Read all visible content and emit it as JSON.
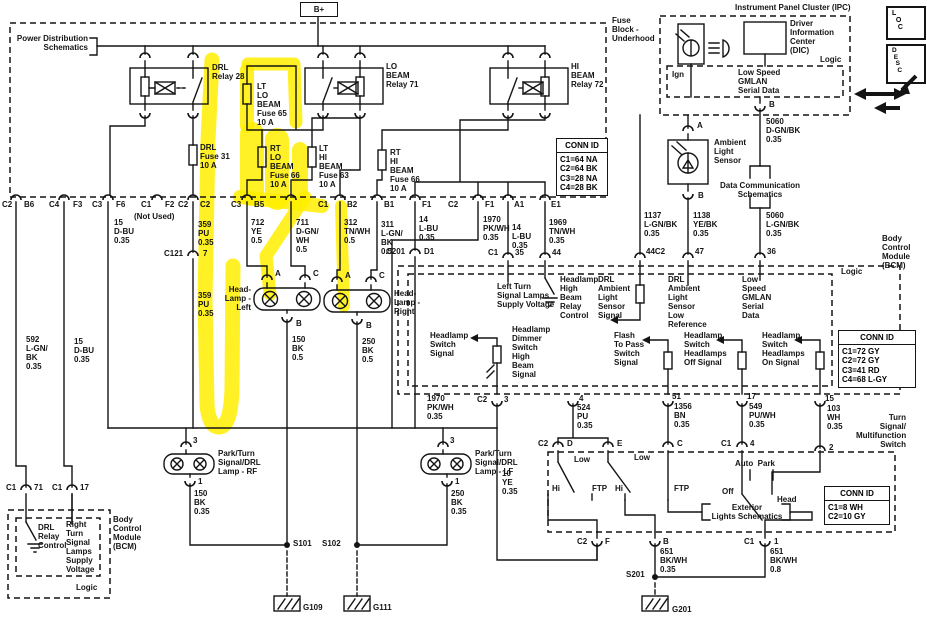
{
  "power": {
    "bplus": "B+",
    "schematics": "Power Distribution\nSchematics",
    "fuse_block": "Fuse\nBlock -\nUnderhood"
  },
  "relays": {
    "drl": "DRL\nRelay 28",
    "lo": "LO\nBEAM\nRelay 71",
    "hi": "HI\nBEAM\nRelay 72"
  },
  "fuses": {
    "lt_lo": "LT\nLO\nBEAM\nFuse 65\n10 A",
    "drl": "DRL\nFuse 31\n10 A",
    "rt_lo": "RT\nLO\nBEAM\nFuse 66\n10 A",
    "lt_hi": "LT\nHI\nBEAM\nFuse 63\n10 A",
    "rt_hi": "RT\nHI\nBEAM\nFuse 66\n10 A"
  },
  "ipc": {
    "title": "Instrument Panel Cluster (IPC)",
    "dic": "Driver\nInformation\nCenter\n(DIC)",
    "logic": "Logic",
    "ign": "Ign",
    "gmlan": "Low Speed\nGMLAN\nSerial Data",
    "pin_b": "B"
  },
  "badges": {
    "loc": "L\n  O\n   C",
    "desc": "D\n E\n  S\n   C"
  },
  "sensor": {
    "label": "Ambient\nLight\nSensor",
    "pin_a": "A",
    "pin_b": "B"
  },
  "datacomm": {
    "label": "Data Communication\nSchematics"
  },
  "conn_ids": {
    "title": "CONN ID",
    "fuse_block": "C1=64 NA\nC2=64 BK\nC3=28 NA\nC4=28 BK",
    "bcm": "C1=72 GY\nC2=72 GY\nC3=41 RD\nC4=68 L-GY",
    "tsmfs": "C1=8 WH\nC2=10 GY"
  },
  "row": {
    "c2a": "C2",
    "b6": "B6",
    "c4": "C4",
    "f3": "F3",
    "c3a": "C3",
    "f6": "F6",
    "c1a": "C1",
    "f2": "F2",
    "not_used": "(Not Used)",
    "c2b": "C2",
    "c2c": "C2",
    "c3b": "C3",
    "b5": "B5",
    "c1b": "C1",
    "b2": "B2",
    "b1": "B1",
    "f1a": "F1",
    "c2d": "C2",
    "f1b": "F1",
    "a1": "A1",
    "e1": "E1"
  },
  "wires": {
    "w15a": "15\nD-BU\n0.35",
    "w359a": "359\nPU\n0.35",
    "w712": "712\nYE\n0.5",
    "w711": "711\nD-GN/\nWH\n0.5",
    "w312": "312\nTN/WH\n0.5",
    "w311": "311\nL-GN/\nBK\n0.5",
    "w14a": "14\nL-BU\n0.35",
    "w1970a": "1970\nPK/WH\n0.35",
    "w14b": "14\nL-BU\n0.35",
    "w1969": "1969\nTN/WH\n0.35",
    "w359b": "359\nPU\n0.35",
    "w592": "592\nL-GN/\nBK\n0.35",
    "w15b": "15\nD-BU\n0.35",
    "w150a": "150\nBK\n0.5",
    "w250a": "250\nBK\n0.5",
    "w150b": "150\nBK\n0.35",
    "w250b": "250\nBK\n0.35",
    "w5060a": "5060\nD-GN/BK\n0.35",
    "w5060b": "5060\nL-GN/BK\n0.35",
    "w1137": "1137\nL-GN/BK\n0.35",
    "w1138": "1138\nYE/BK\n0.35",
    "w1970b": "1970\nPK/WH\n0.35",
    "w524": "524\nPU\n0.35",
    "w1356": "1356\nBN\n0.35",
    "w549": "549\nPU/WH\n0.35",
    "w103": "103\nWH\n0.35",
    "w10": "10\nYE\n0.35",
    "w651a": "651\nBK/WH\n0.35",
    "w651b": "651\nBK/WH\n0.8"
  },
  "pins": {
    "c121": "C121",
    "c121_7": "7",
    "c201": "C201",
    "d1": "D1",
    "c1a": "C1",
    "p35": "35",
    "p44": "44",
    "p44c2": "44C2",
    "p47": "47",
    "p36": "36",
    "hl_a": "A",
    "hl_c": "C",
    "hl_b": "B",
    "hr_a": "A",
    "hr_c": "C",
    "hr_b": "B",
    "rf_3": "3",
    "rf_1": "1",
    "lf_3": "3",
    "lf_1": "1",
    "bp_c2": "C2",
    "bp_3": "3",
    "bp_4": "4",
    "bp_51": "51",
    "bp_17": "17",
    "bp_15": "15",
    "ts_c2": "C2",
    "ts_d": "D",
    "ts_e": "E",
    "ts_c": "C",
    "ts_c1": "C1",
    "ts_4": "4",
    "ts_2": "2",
    "eb_c2": "C2",
    "eb_f": "F",
    "eb_b": "B",
    "eb_c1": "C1",
    "eb_1": "1",
    "lb_c1a": "C1",
    "lb_71": "71",
    "lb_c1b": "C1",
    "lb_17": "17"
  },
  "headlamps": {
    "left": "Head-\nLamp -\nLeft",
    "right": "Head-\nLamp -\nRight"
  },
  "park_lamps": {
    "rf": "Park/Turn\nSignal/DRL\nLamp - RF",
    "lf": "Park/Turn\nSignal/DRL\nLamp - LF"
  },
  "bcm": {
    "name": "Body\nControl\nModule\n(BCM)",
    "logic": "Logic",
    "lt_supply": "Left Turn\nSignal Lamps\nSupply Voltage",
    "hhbrc": "Headlamp\nHigh\nBeam\nRelay\nControl",
    "drl_als": "DRL\nAmbient\nLight\nSensor\nSignal",
    "drl_als_lr": "DRL\nAmbient\nLight\nSensor\nLow\nReference",
    "gmlan": "Low\nSpeed\nGMLAN\nSerial\nData",
    "hss": "Headlamp\nSwitch\nSignal",
    "dimmer": "Headlamp\nDimmer\nSwitch\nHigh\nBeam\nSignal",
    "ftp": "Flash\nTo Pass\nSwitch\nSignal",
    "hs_off": "Headlamp\nSwitch\nHeadlamps\nOff Signal",
    "hs_on": "Headlamp\nSwitch\nHeadlamps\nOn Signal"
  },
  "bcm_left": {
    "name": "Body\nControl\nModule\n(BCM)",
    "logic": "Logic",
    "drl_ctl": "DRL\nRelay\nControl",
    "rt_supply": "Right\nTurn\nSignal\nLamps\nSupply\nVoltage"
  },
  "tsmfs": {
    "name": "Turn\nSignal/\nMultifunction\nSwitch",
    "low1": "Low",
    "low2": "Low",
    "hi1": "Hi",
    "ftp1": "FTP",
    "hi2": "Hi",
    "ftp2": "FTP",
    "off": "Off",
    "auto_park": "Auto  Park",
    "head": "Head",
    "ext": "Exterior\nLights Schematics"
  },
  "splices": {
    "s101": "S101",
    "s102": "S102",
    "s201": "S201"
  },
  "grounds": {
    "g109": "G109",
    "g111": "G111",
    "g201": "G201"
  }
}
